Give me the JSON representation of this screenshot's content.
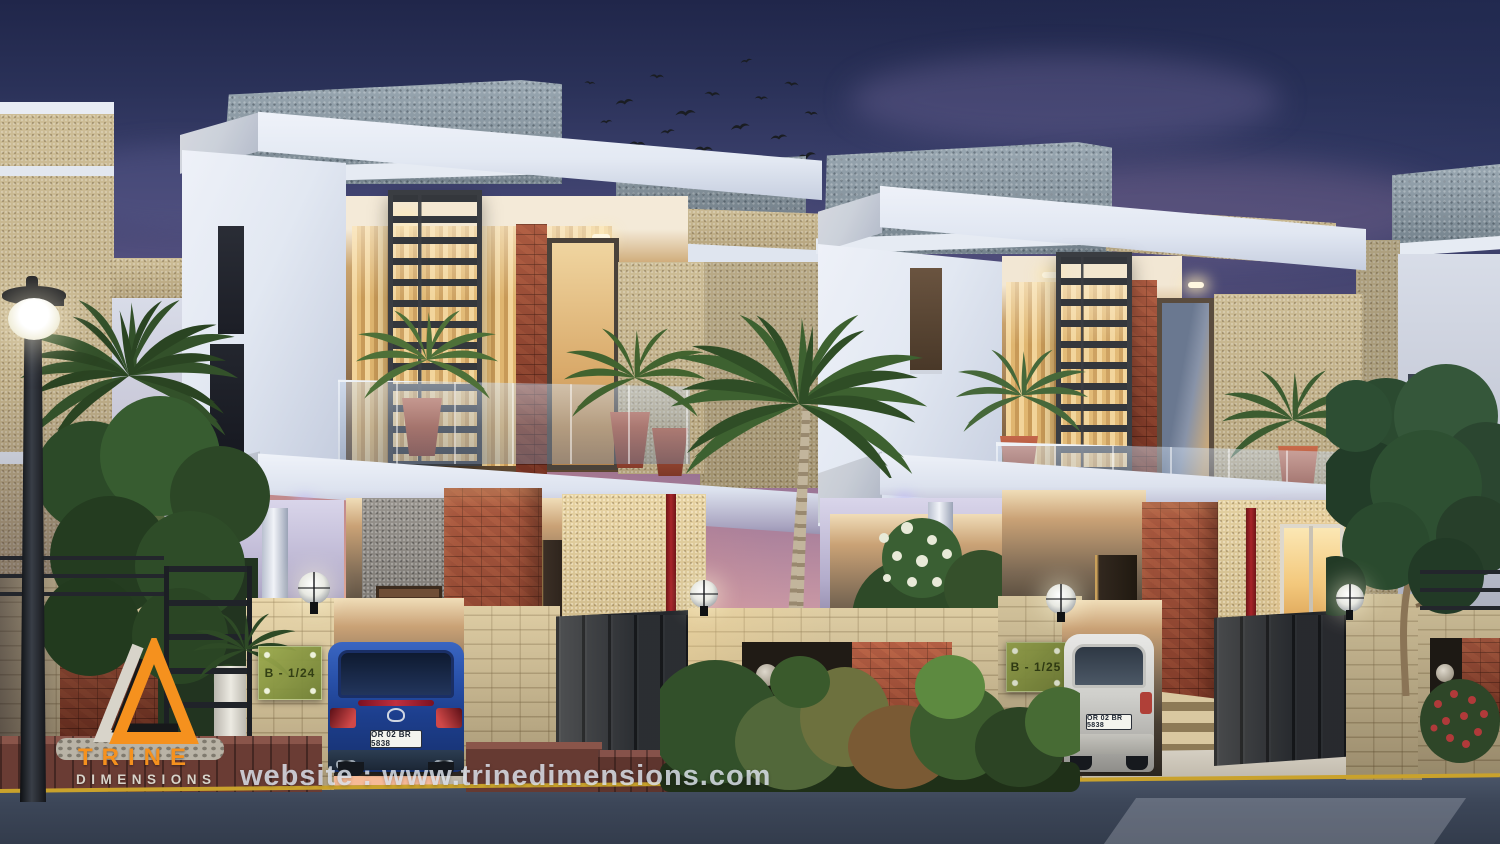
{
  "scene": {
    "description": "Dusk 3D architectural rendering of two modern duplex villas with balconies, carports, compound walls, gates, palm trees, garden and two parked cars",
    "time_of_day": "dusk"
  },
  "branding": {
    "logo_primary": "TRINE",
    "logo_secondary": "DIMENSIONS",
    "colors": {
      "orange": "#F5911E",
      "light_gray": "#D8D4CA",
      "black": "#17181A"
    }
  },
  "footer": {
    "website": "website : www.trinedimensions.com"
  },
  "houses": [
    {
      "id": "villa-left",
      "plate": "B - 1/24"
    },
    {
      "id": "villa-right",
      "plate": "B - 1/25"
    }
  ],
  "vehicles": [
    {
      "id": "blue-sedan",
      "body_color": "#2450A8",
      "license_plate": "OR 02 BR 5838"
    },
    {
      "id": "white-hatchback",
      "body_color": "#D9D9D5",
      "license_plate": "OR 02 BR 5838"
    }
  ],
  "palette": {
    "sky_top": "#20264A",
    "sky_mid_purple": "#6F5D86",
    "sunset_pink": "#E2ADA6",
    "sunset_orange": "#F7D3AB",
    "wall_white": "#E8ECF5",
    "stone_beige": "#D2C29A",
    "brick_red": "#9A4530",
    "roof_gray": "#87959F",
    "window_warm": "#F2D49A",
    "metal_dark": "#34383E",
    "road": "#3C4658",
    "curb_maroon": "#6A3C34",
    "road_line_yellow": "#C9A22C"
  }
}
